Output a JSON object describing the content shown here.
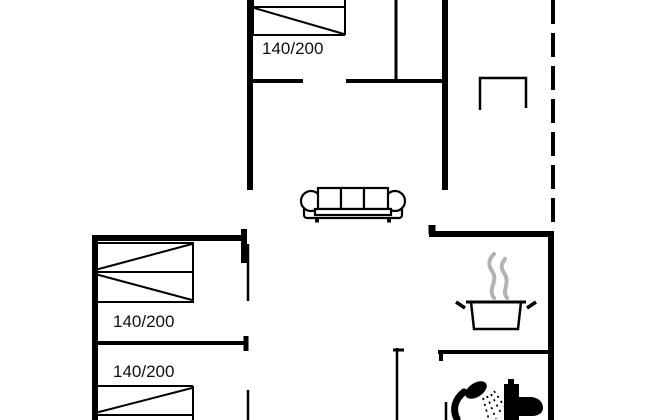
{
  "floor_plan": {
    "beds": [
      {
        "name": "bed-top",
        "size_label": "140/200"
      },
      {
        "name": "bed-middle-left",
        "size_label": "140/200"
      },
      {
        "name": "bed-bottom-left",
        "size_label": "140/200"
      }
    ],
    "furniture_icons": [
      "sofa-icon",
      "terrace-table-icon",
      "cooking-pot-icon",
      "steam-icon",
      "shower-icon",
      "toilet-icon"
    ],
    "colors": {
      "wall": "#000000",
      "steam": "#b3b3b3",
      "background": "#ffffff"
    }
  }
}
